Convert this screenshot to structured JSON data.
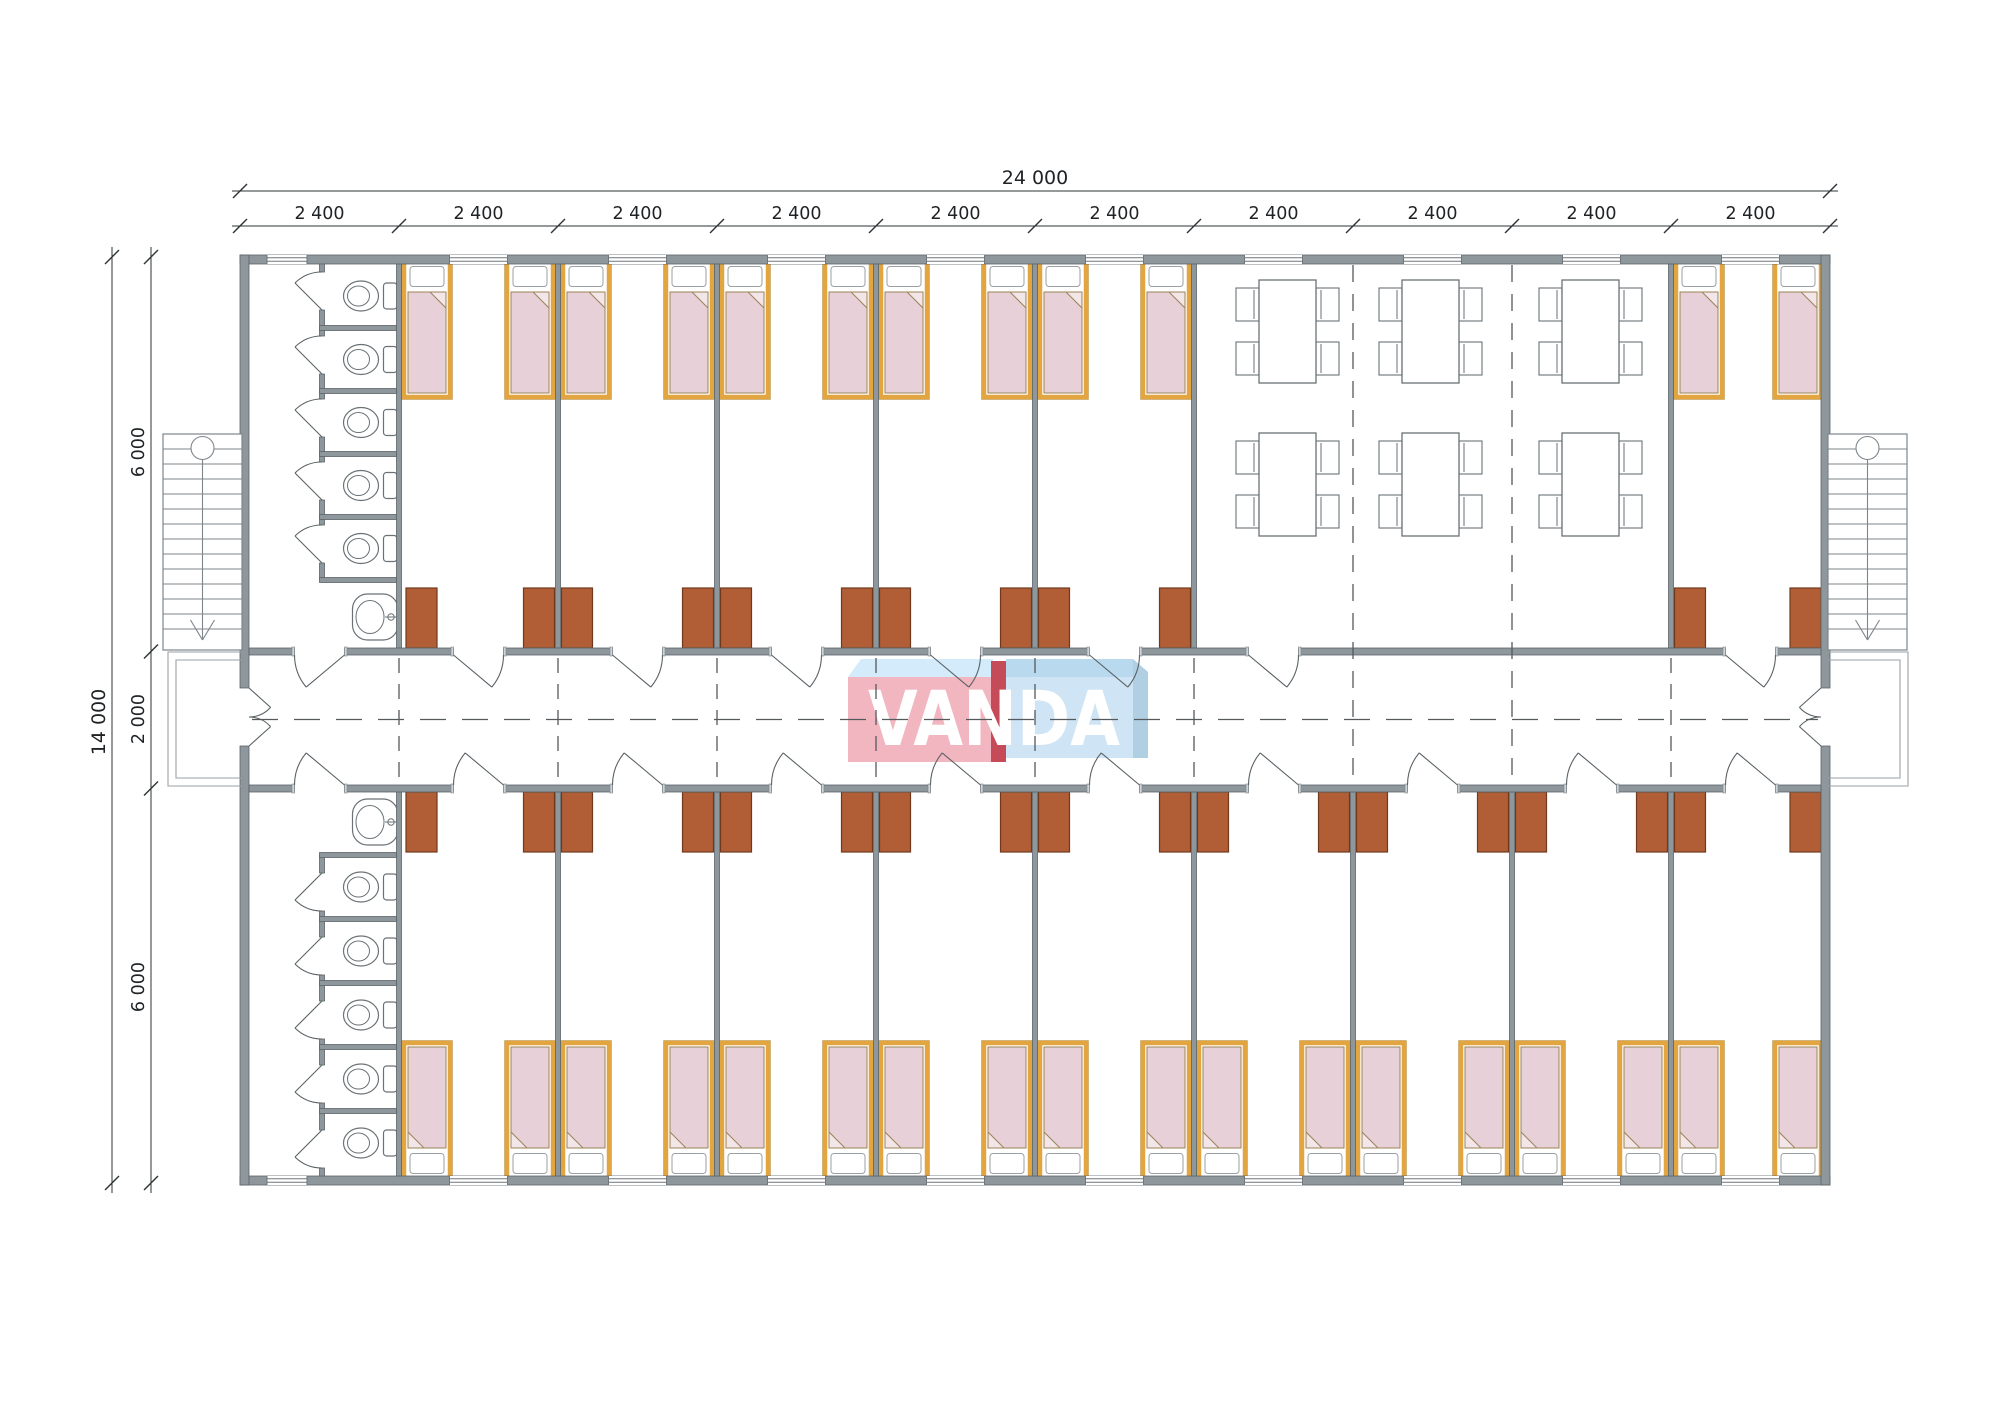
{
  "drawing": {
    "kind": "container dormitory floor plan",
    "logo": {
      "text": "VANDA"
    },
    "dimensions": {
      "overall_width": "24 000",
      "module_width": "2 400",
      "module_count": 10,
      "overall_height": "14 000",
      "height_segments": [
        "6 000",
        "2 000",
        "6 000"
      ]
    },
    "inventory": {
      "bedrooms": 15,
      "beds": 30,
      "wardrobes": 30,
      "toilet_stalls": 10,
      "sinks": 2,
      "dining_tables": 6,
      "chairs": 24,
      "staircases": 2,
      "entrances": 2
    },
    "palette": {
      "wall_fill": "#8e979c",
      "wall_stroke": "#5c656a",
      "line": "#5a6266",
      "thin": "#6f777b",
      "fixture": "#6a7276",
      "stairs": "#7d868b",
      "porch": "#9aa2a6",
      "dash": "#54595c",
      "bed_frame": "#e2a53f",
      "bed_frame_edge": "#a07a2f",
      "mattress": "#e7d0d7",
      "mattress_line": "#9c8358",
      "fold": "#f2e6e9",
      "pillow_line": "#9aa0a4",
      "wardrobe": "#b15e36",
      "wardrobe_stroke": "#70391c",
      "dim": "#2e3336",
      "text": "#1f2326",
      "logo_pink": "#f2b6c0",
      "logo_red": "#c54b59",
      "logo_top_blue": "#d3ebfa",
      "logo_blue": "#cfe4f4",
      "logo_blue_dark": "#b9d9ee",
      "logo_shadow_blue": "#b0cfe3",
      "logo_text": "#ffffff"
    }
  }
}
